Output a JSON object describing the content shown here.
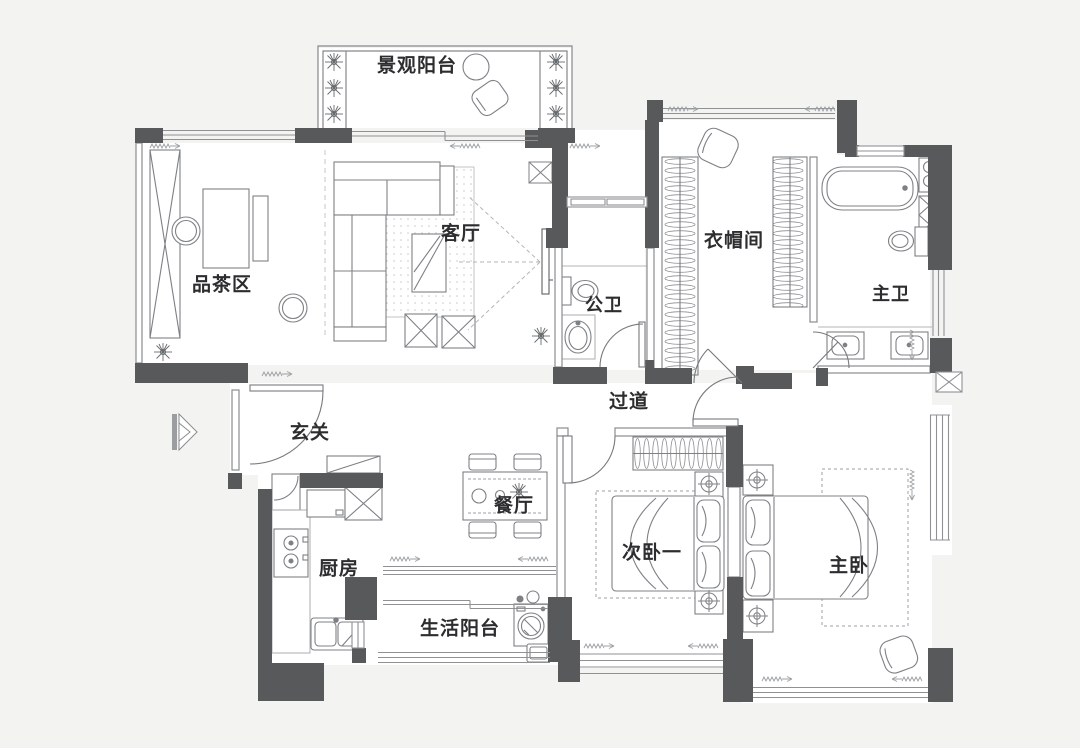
{
  "plan": {
    "type": "apartment-floor-plan",
    "rooms": [
      {
        "id": "landscape_balcony",
        "label": "景观阳台"
      },
      {
        "id": "tea_area",
        "label": "品茶区"
      },
      {
        "id": "living_room",
        "label": "客厅"
      },
      {
        "id": "public_bath",
        "label": "公卫"
      },
      {
        "id": "cloakroom",
        "label": "衣帽间"
      },
      {
        "id": "master_bath",
        "label": "主卫"
      },
      {
        "id": "entry",
        "label": "玄关"
      },
      {
        "id": "corridor",
        "label": "过道"
      },
      {
        "id": "dining",
        "label": "餐厅"
      },
      {
        "id": "kitchen",
        "label": "厨房"
      },
      {
        "id": "service_balcony",
        "label": "生活阳台"
      },
      {
        "id": "bedroom2",
        "label": "次卧一"
      },
      {
        "id": "master_bedroom",
        "label": "主卧"
      }
    ],
    "colors": {
      "wall": "#58595b",
      "furniture_line": "#7d8084",
      "light_line": "#aab0b3",
      "text": "#2d2d2f",
      "paper": "#f3f3f2",
      "floor": "#ffffff"
    }
  }
}
